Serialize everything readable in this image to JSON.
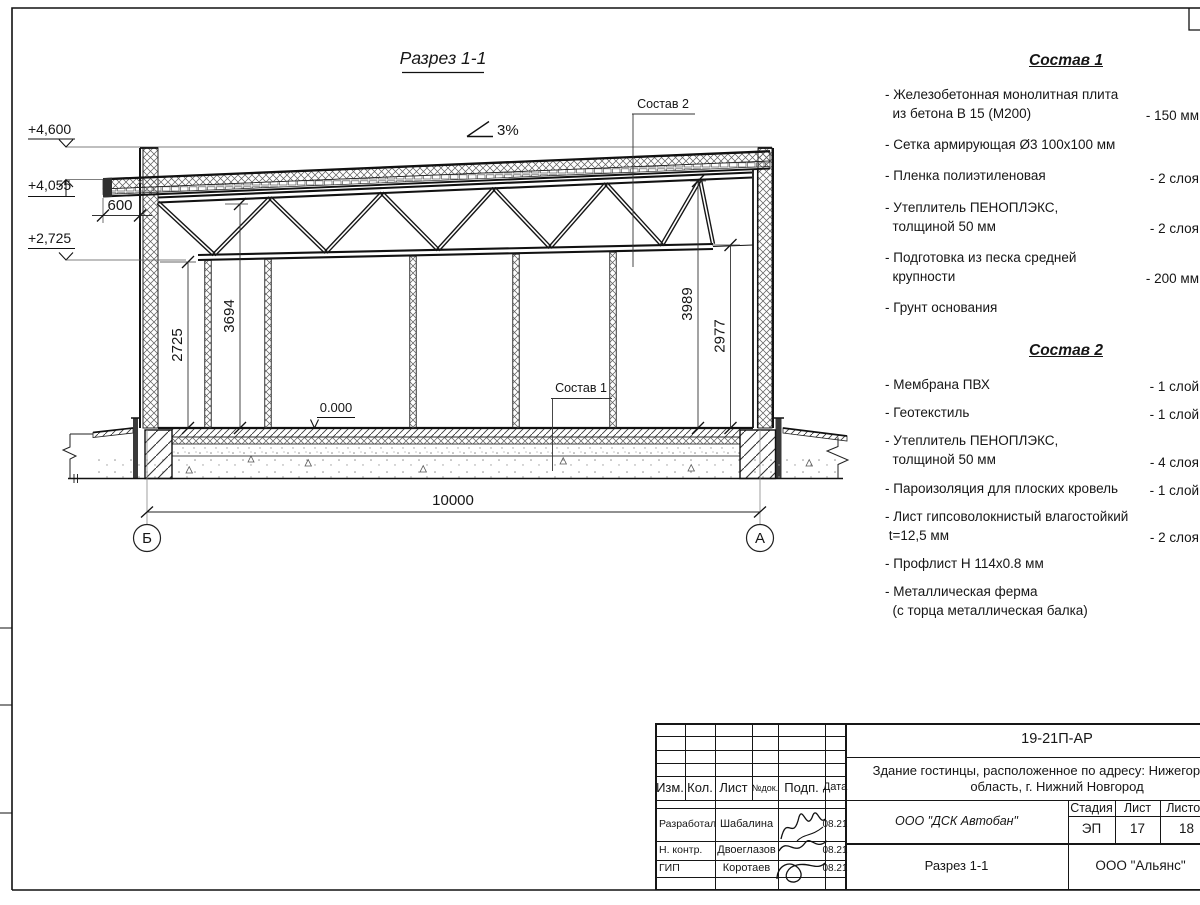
{
  "sheet": {
    "drawing_title": "Разрез 1-1",
    "slope": "3%",
    "elevations": {
      "top": "+4,600",
      "canopy": "+4,055",
      "truss": "+2,725",
      "zero": "0.000"
    },
    "dimensions": {
      "overhang": "600",
      "wall_left": "2725",
      "truss_left": "3694",
      "roof_right": "3989",
      "truss_right": "2977",
      "span": "10000"
    },
    "axes": {
      "left": "Б",
      "right": "А"
    },
    "callouts": {
      "sostav1": "Состав 1",
      "sostav2": "Состав 2"
    }
  },
  "sostav1": {
    "title": "Состав 1",
    "items": [
      {
        "name": "- Железобетонная  монолитная плита\n  из бетона В 15 (М200)",
        "value": "- 150 мм"
      },
      {
        "name": "- Сетка армирующая Ø3 100х100 мм",
        "value": ""
      },
      {
        "name": "- Пленка полиэтиленовая",
        "value": "-  2 слоя"
      },
      {
        "name": "- Утеплитель ПЕНОПЛЭКС,\n  толщиной 50 мм",
        "value": "- 2 слоя"
      },
      {
        "name": "- Подготовка из песка средней\n  крупности",
        "value": "- 200 мм"
      },
      {
        "name": "- Грунт основания",
        "value": ""
      }
    ]
  },
  "sostav2": {
    "title": "Состав 2",
    "items": [
      {
        "name": "- Мембрана ПВХ",
        "value": "- 1 слой"
      },
      {
        "name": "- Геотекстиль",
        "value": "- 1 слой"
      },
      {
        "name": "- Утеплитель ПЕНОПЛЭКС,\n  толщиной 50 мм",
        "value": "- 4 слоя"
      },
      {
        "name": "- Пароизоляция для плоских кровель",
        "value": "- 1 слой"
      },
      {
        "name": "- Лист гипсоволокнистый влагостойкий\n t=12,5 мм",
        "value": "- 2 слоя"
      },
      {
        "name": "- Профлист Н 114х0.8 мм",
        "value": ""
      },
      {
        "name": "- Металлическая ферма\n  (с торца металлическая балка)",
        "value": ""
      }
    ]
  },
  "titleblock": {
    "doc_number": "19-21П-АР",
    "project_line1": "Здание гостинцы, расположенное по адресу: Нижегородская",
    "project_line2": "область, г. Нижний Новгород",
    "contractor": "ООО \"ДСК Автобан\"",
    "stage_label": "Стадия",
    "sheet_label": "Лист",
    "sheets_label": "Листов",
    "stage": "ЭП",
    "sheet": "17",
    "sheets": "18",
    "drawing_name": "Разрез 1-1",
    "organization": "ООО \"Альянс\"",
    "columns": [
      "Изм.",
      "Кол.",
      "Лист",
      "№док.",
      "Подп.",
      "Дата"
    ],
    "signers": [
      {
        "role": "Разработал",
        "name": "Шабалина",
        "date": "08.21"
      },
      {
        "role": "Н. контр.",
        "name": "Двоеглазов",
        "date": "08.21"
      },
      {
        "role": "ГИП",
        "name": "Коротаев",
        "date": "08.21"
      }
    ]
  }
}
